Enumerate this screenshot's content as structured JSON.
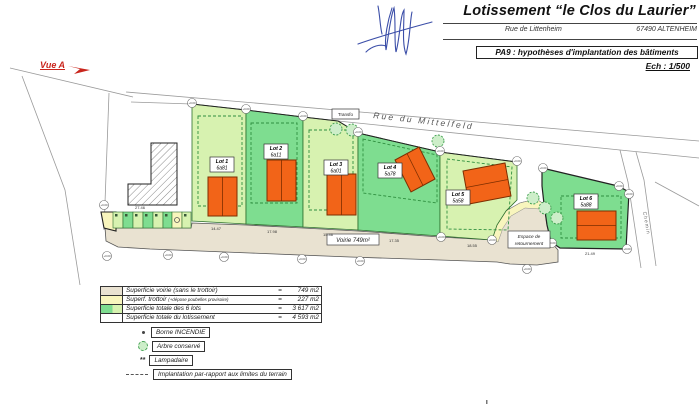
{
  "title_block": {
    "title": "Lotissement “le Clos du Laurier”",
    "address_street": "Rue de Littenheim",
    "address_city": "67490 ALTENHEIM",
    "doc_label": "PA9 : hypothèses d'implantation des bâtiments",
    "scale_label": "Ech : 1/500"
  },
  "view_arrow": {
    "label": "Vue A"
  },
  "plan": {
    "street_name": "Rue du Mittelfeld",
    "transfo_label": "Transfo",
    "voirie_label": "Voirie 749m²",
    "turnaround_line1": "Espace de",
    "turnaround_line2": "retournement",
    "chemin_label": "Chemin",
    "level_marker_text": "+0.00",
    "dims": {
      "stalls": "27.46",
      "lot1": "14.47",
      "lot2": "17.98",
      "lot3": "15.46",
      "lot4": "17.35",
      "lot5": "18.55",
      "lot6": "21.49"
    }
  },
  "lots": [
    {
      "name": "Lot 1",
      "area": "6a81"
    },
    {
      "name": "Lot 2",
      "area": "6a11"
    },
    {
      "name": "Lot 3",
      "area": "6a01"
    },
    {
      "name": "Lot 4",
      "area": "5a78"
    },
    {
      "name": "Lot 5",
      "area": "5a58"
    },
    {
      "name": "Lot 6",
      "area": "5a88"
    }
  ],
  "legend": {
    "equals": "=",
    "rows": [
      {
        "label": "Superficie voirie (sans le trottoir)",
        "note": "",
        "value": "749 m2"
      },
      {
        "label": "Superf. trottoir",
        "note": "(+dépose poubelles provisoire)",
        "value": "227 m2"
      },
      {
        "label": "Superficie totale des 6 lots",
        "note": "",
        "value": "3 617 m2"
      },
      {
        "label": "Superficie totale du lotissement",
        "note": "",
        "value": "4 593 m2"
      }
    ],
    "items": [
      {
        "label": "Borne INCENDIE",
        "icon": "hydrant-dot-icon"
      },
      {
        "label": "Arbre conservé",
        "icon": "preserved-tree-icon"
      },
      {
        "label": "Lampadaire",
        "icon": "street-lamp-icon"
      },
      {
        "label": "Implantation par-rapport aux limites du terrain",
        "icon": "dashed-line-icon"
      }
    ]
  },
  "colors": {
    "lot_light": "#d7f2b0",
    "lot_medium": "#7edd90",
    "building_orange": "#f26418",
    "road_tan": "#e9e2d1",
    "sidewalk_yellow": "#f8f5bd",
    "accent_red": "#c9251c",
    "signature_blue": "#3b4ea8"
  }
}
